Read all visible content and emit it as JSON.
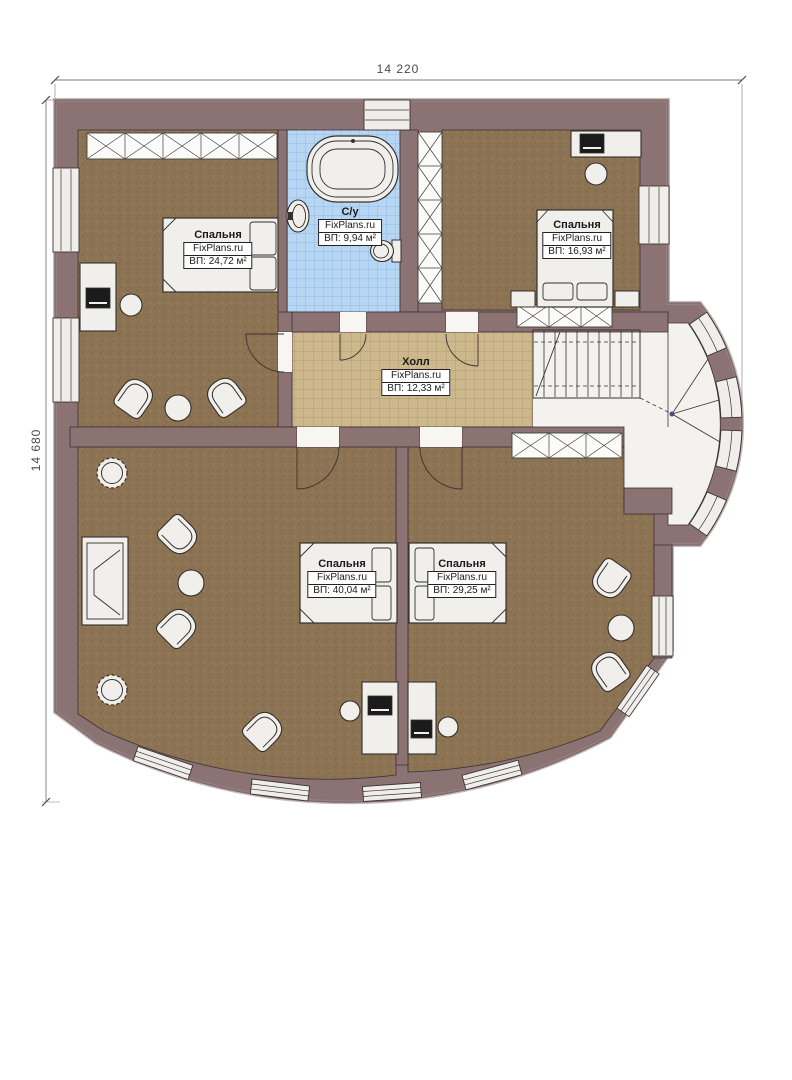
{
  "plan": {
    "title": "floor-plan",
    "dimensions": {
      "top": "14 220",
      "left": "14 680"
    },
    "rooms": [
      {
        "id": "bedroom-top-left",
        "name": "Спальня",
        "brand": "FixPlans.ru",
        "area": "ВП: 24,72 м²"
      },
      {
        "id": "bathroom",
        "name": "С/у",
        "brand": "FixPlans.ru",
        "area": "ВП: 9,94 м²"
      },
      {
        "id": "bedroom-top-right",
        "name": "Спальня",
        "brand": "FixPlans.ru",
        "area": "ВП: 16,93 м²"
      },
      {
        "id": "hall",
        "name": "Холл",
        "brand": "FixPlans.ru",
        "area": "ВП: 12,33 м²"
      },
      {
        "id": "bedroom-bottom-left",
        "name": "Спальня",
        "brand": "FixPlans.ru",
        "area": "ВП: 40,04 м²"
      },
      {
        "id": "bedroom-bottom-right",
        "name": "Спальня",
        "brand": "FixPlans.ru",
        "area": "ВП: 29,25 м²"
      }
    ],
    "colors": {
      "wall": "#8b7273",
      "wall_outline": "#3f3335",
      "wood_floor": "#8c7354",
      "hall_tile": "#cdb88d",
      "bath_tile": "#b7d6f3",
      "furniture": "#f0efeb",
      "paper": "#ffffff"
    }
  }
}
